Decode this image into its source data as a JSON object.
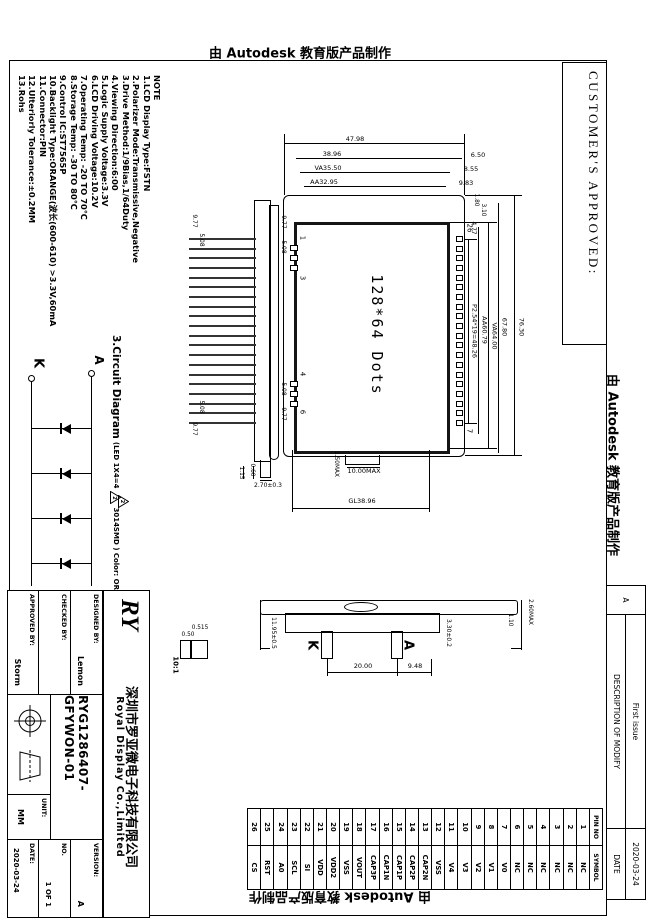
{
  "watermark": "由 Autodesk 教育版产品制作",
  "customer_approved": "CUSTOMER'S APPROVED:",
  "revision_table": {
    "rev": "A",
    "description_header": "DESCRIPTION OF MODIFY",
    "description_value": "First issue",
    "date_header": "DATE",
    "date_value": "2020-03-24"
  },
  "notes": {
    "title": "NOTE",
    "items": [
      "1.LCD Display Type:FSTN",
      "2.Polarizer Mode:Transmissive,Negative",
      "3.Drive Method:1/9Bias,1/64Duty",
      "4.Viewing Direction:6:00",
      "5.Logic Supply Voltage:3.3V",
      "6.LCD Driving Voltage:10.2V",
      "7.Operating Temp: -20 TO 70℃",
      "8.Storage Temp: -30 TO 80℃",
      "9.Control IC:ST7565P",
      "10.Backlight Type:ORANGE(波长(600-610) >3.3V,60mA",
      "11.Connector:PIN",
      "12.Ulteriorly Tolerance:±0.2MM",
      "13.Rohs"
    ]
  },
  "front_view": {
    "display_text": "128*64 Dots",
    "dims": {
      "overall_h": "47.98",
      "glass_h": "38.96",
      "va_h": "VA35.50",
      "aa_h": "AA32.95",
      "off1": "6.50",
      "off2": "8.55",
      "off3": "9.83",
      "pad_off1": "1.80",
      "pad_off2": "3.10",
      "pad_off3": "4.77",
      "pad_pitch": "P2.54*19=48.26",
      "aa_w": "AA60.79",
      "va_w": "VA64.00",
      "glass_w2": "67.80",
      "overall_w": "76.30",
      "gl": "GL38.96",
      "tab_w": "10.00MAX",
      "tab_t": "1.50MAX",
      "grp1_a": "9.77",
      "grp1_b": "5.08",
      "grp2_a": "5.08",
      "grp2_b": "9.77"
    },
    "pad_labels": {
      "top_left": "26",
      "top_right": "7",
      "b1": "1",
      "b2": "3",
      "b3": "4",
      "b4": "6"
    }
  },
  "side_view": {
    "dims": {
      "a": "9.77",
      "b": "5.08",
      "c": "5.08",
      "d": "9.77",
      "e": "2.70±0.3",
      "f": "1.15",
      "g": "0.60"
    }
  },
  "backlight_view": {
    "k": "K",
    "a": "A",
    "dims": {
      "pitch": "20.00",
      "off": "9.48",
      "h": "11.95±0.5",
      "t": "3.30±0.2",
      "g1": "1.10",
      "g2": "2.60MAX"
    }
  },
  "detail_view": {
    "scale": "10:1",
    "dims": {
      "a": "0.515",
      "b": "0.50"
    }
  },
  "circuit": {
    "title": "3.Circuit Diagram",
    "spec_pre": "(LED 1X4=4",
    "marker": "2",
    "spec_post": "3014SMD ) Color: ORANGE",
    "anode": "A",
    "cathode": "K"
  },
  "pin_table": {
    "headers": [
      "PIN NO",
      "SYMBOL"
    ],
    "pins": [
      {
        "no": "1",
        "symbol": "NC"
      },
      {
        "no": "2",
        "symbol": "NC"
      },
      {
        "no": "3",
        "symbol": "NC"
      },
      {
        "no": "4",
        "symbol": "NC"
      },
      {
        "no": "5",
        "symbol": "NC"
      },
      {
        "no": "6",
        "symbol": "NC"
      },
      {
        "no": "7",
        "symbol": "V0"
      },
      {
        "no": "8",
        "symbol": "V1"
      },
      {
        "no": "9",
        "symbol": "V2"
      },
      {
        "no": "10",
        "symbol": "V3"
      },
      {
        "no": "11",
        "symbol": "V4"
      },
      {
        "no": "12",
        "symbol": "VSS"
      },
      {
        "no": "13",
        "symbol": "CAP2N"
      },
      {
        "no": "14",
        "symbol": "CAP2P"
      },
      {
        "no": "15",
        "symbol": "CAP1P"
      },
      {
        "no": "16",
        "symbol": "CAP1N"
      },
      {
        "no": "17",
        "symbol": "CAP3P"
      },
      {
        "no": "18",
        "symbol": "VOUT"
      },
      {
        "no": "19",
        "symbol": "VSS"
      },
      {
        "no": "20",
        "symbol": "VDD2"
      },
      {
        "no": "21",
        "symbol": "VDD"
      },
      {
        "no": "22",
        "symbol": "SI"
      },
      {
        "no": "23",
        "symbol": "SCL"
      },
      {
        "no": "24",
        "symbol": "A0"
      },
      {
        "no": "25",
        "symbol": "RST"
      },
      {
        "no": "26",
        "symbol": "CS"
      }
    ]
  },
  "title_block": {
    "logo": "RY",
    "company_cn": "深圳市罗亚微电子科技有限公司",
    "company_en": "Royal Display Co.,Limited",
    "designed_by_label": "DESIGNED BY:",
    "designed_by": "Lemon",
    "checked_by_label": "CHECKED BY:",
    "checked_by": "",
    "approved_by_label": "APPROVED BY:",
    "approved_by": "Storm",
    "part_number": "RYG1286407-GFYWON-01",
    "version_label": "VERSION:",
    "version": "A",
    "no_label": "NO.",
    "no_value": "1 OF 1",
    "unit_label": "UNIT:",
    "unit": "MM",
    "date_label": "DATE:",
    "date": "2020-03-24"
  }
}
